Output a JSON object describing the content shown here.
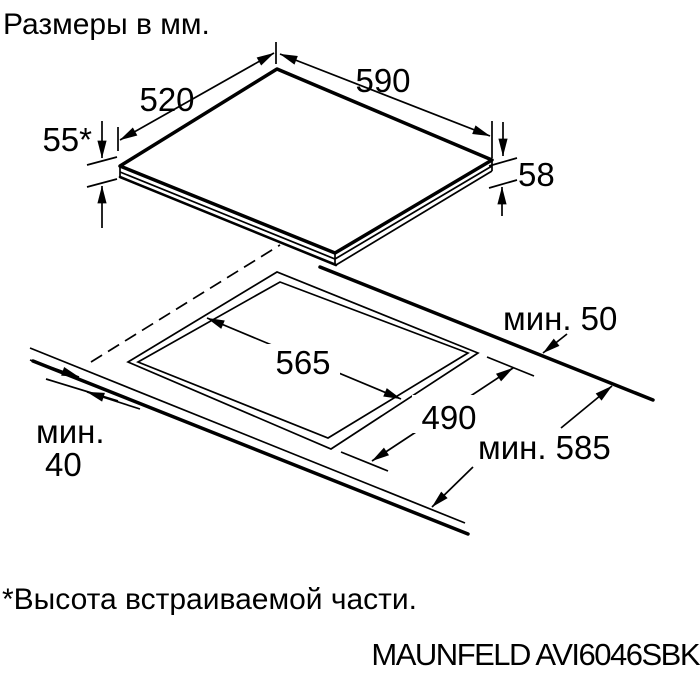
{
  "title": "Размеры в мм.",
  "diagram": {
    "top_view": {
      "width_label": "590",
      "depth_label": "520",
      "built_in_height_label": "55*",
      "overall_height_label": "58"
    },
    "cutout_view": {
      "cutout_width_label": "565",
      "cutout_depth_label": "490",
      "rear_clearance_label": "мин. 50",
      "front_clearance_label_line1": "мин.",
      "front_clearance_label_line2": "40",
      "worktop_depth_label": "мин. 585"
    }
  },
  "footnote": "*Высота встраиваемой части.",
  "model": "MAUNFELD AVI6046SBK",
  "colors": {
    "line": "#000000",
    "background": "#ffffff"
  }
}
